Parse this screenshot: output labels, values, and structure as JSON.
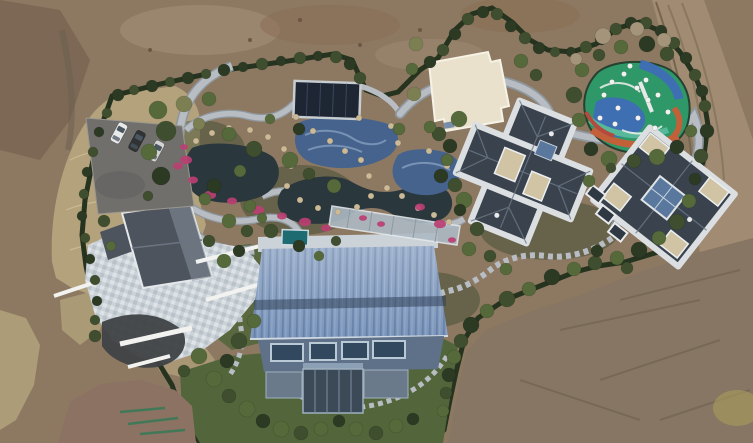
{
  "scene": {
    "type": "aerial-drone-photo",
    "description": "Top-down aerial drone photograph of a private landscaped estate under construction, surrounded by bare graded earth. The walled green compound contains an ornamental pond garden with winding stone paths and magenta flower beds, a dark solar canopy, a blue mosaic pool, a cream flat-roofed pavilion, a colorful children's playground, two dark slate-roofed villas with white roof rims, a gable-roofed house with a large stone patio, a big hall with a blue standing-seam metal roof, a glass walkway bridge, a small parking lot with three cars, and a curving asphalt driveway. A dirt track runs along the upper right edge.",
    "objects": [
      "bare earth surroundings",
      "boundary hedge",
      "dry grass bank",
      "asphalt driveway",
      "parking area with three cars",
      "ornamental pond garden",
      "winding stone paths",
      "magenta flower beds",
      "solar panel canopy",
      "blue mosaic pools",
      "cream flat-roof pavilion",
      "children's playground",
      "perimeter garden road",
      "slate-roof villa (center)",
      "slate-roof villa (east)",
      "gable-roof house with stone patio",
      "blue metal-roof hall",
      "glass walkway bridge",
      "stepped garden path",
      "white retaining walls",
      "lawn",
      "dirt access road",
      "green survey paint marks"
    ]
  },
  "colors": {
    "dirt_base": "#8d7962",
    "dirt_dark": "#6b5745",
    "dirt_red": "#8a6c52",
    "dirt_light": "#a5907a",
    "dirt_gray": "#877663",
    "dirt_patch": "#8b7263",
    "ridge": "#6a5d4e",
    "patch_yellow": "#a79a5c",
    "dry_grass": "#b3a27c",
    "dry_grass_light": "#cfc09a",
    "hedge": "#26331f",
    "garden": "#46543a",
    "garden_dark": "#39482e",
    "lawn": "#53663b",
    "bush_dark": "#2c3a24",
    "bush_mid": "#3e4e2e",
    "bush_green": "#55693a",
    "bush_olive": "#7c7f52",
    "bush_pale": "#95a46b",
    "tree_bare": "#a3947a",
    "road_asphalt": "#3f4245",
    "road_edge": "#d5d3cd",
    "dirt_road": "#a18c73",
    "rut": "#7f6e59",
    "path_stone": "#b7bdc2",
    "path_edge": "#8f979e",
    "patio_a": "#ccd3d8",
    "patio_b": "#dde3e7",
    "patio_c": "#b9c2c9",
    "pond": "#2a383d",
    "pool_blue": "#45638d",
    "pool_wave": "#7e98ba",
    "flower": "#bb3f72",
    "rock": "#ccba96",
    "wall_white": "#f2f3f1",
    "roof_slate": "#3a434d",
    "roof_rim": "#dcdfe2",
    "roof_tan": "#d0c4a5",
    "skylight": "#5a789e",
    "facet": "#6d7987",
    "roof_gable": "#4d545e",
    "gable_sheen": "#858e9b",
    "barn_roof": "#7b95ba",
    "barn_rib": "#5f7aa4",
    "barn_rib_light": "#93abc9",
    "barn_dark_band": "#2f4158",
    "barn_eave": "#cfd8e2",
    "facade": "#5e7188",
    "window": "#31485e",
    "window_frame": "#b9c9d6",
    "louver": "#6b7a8a",
    "glass_dark": "#3c4a57",
    "glass_mullion": "#7b8da0",
    "hottub": "#1f6b72",
    "bridge": "#aebac4",
    "pavilion": "#e9e1cc",
    "pavilion_edge": "#f6f2e5",
    "pg_green": "#2f9868",
    "pg_blue": "#3e6fb3",
    "pg_teal": "#58b89a",
    "pg_orange": "#c2603a",
    "pg_red": "#b34a3e",
    "pg_white": "#f0f2f0",
    "solar": "#1e2633",
    "solar_frame": "#c8cdd2",
    "car_white": "#e9eaea",
    "car_dark": "#303234",
    "car_silver": "#d3d4d2",
    "car_glass": "#4a5660",
    "paint_green": "#2f7a56"
  },
  "landscape": {
    "shrubs": [
      [
        118,
        95,
        6,
        0
      ],
      [
        134,
        90,
        5,
        1
      ],
      [
        152,
        86,
        6,
        0
      ],
      [
        170,
        82,
        5,
        1
      ],
      [
        188,
        78,
        6,
        0
      ],
      [
        206,
        74,
        5,
        1
      ],
      [
        224,
        70,
        6,
        0
      ],
      [
        243,
        67,
        5,
        0
      ],
      [
        262,
        64,
        6,
        1
      ],
      [
        281,
        61,
        5,
        0
      ],
      [
        300,
        58,
        6,
        1
      ],
      [
        318,
        56,
        5,
        0
      ],
      [
        336,
        57,
        6,
        1
      ],
      [
        350,
        64,
        6,
        0
      ],
      [
        360,
        78,
        6,
        1
      ],
      [
        430,
        62,
        6,
        0
      ],
      [
        443,
        50,
        6,
        1
      ],
      [
        455,
        34,
        6,
        0
      ],
      [
        468,
        19,
        6,
        1
      ],
      [
        483,
        12,
        6,
        0
      ],
      [
        497,
        14,
        6,
        1
      ],
      [
        511,
        26,
        6,
        0
      ],
      [
        525,
        38,
        6,
        1
      ],
      [
        539,
        48,
        6,
        0
      ],
      [
        555,
        52,
        5,
        1
      ],
      [
        571,
        52,
        5,
        0
      ],
      [
        586,
        47,
        6,
        1
      ],
      [
        601,
        39,
        6,
        0
      ],
      [
        616,
        29,
        6,
        1
      ],
      [
        631,
        23,
        6,
        0
      ],
      [
        646,
        23,
        6,
        1
      ],
      [
        661,
        31,
        6,
        0
      ],
      [
        674,
        43,
        6,
        1
      ],
      [
        686,
        58,
        6,
        0
      ],
      [
        695,
        75,
        6,
        1
      ],
      [
        702,
        91,
        6,
        0
      ],
      [
        107,
        113,
        5,
        1
      ],
      [
        99,
        132,
        5,
        0
      ],
      [
        93,
        152,
        5,
        1
      ],
      [
        87,
        172,
        5,
        0
      ],
      [
        84,
        194,
        5,
        1
      ],
      [
        82,
        216,
        5,
        0
      ],
      [
        85,
        238,
        5,
        1
      ],
      [
        90,
        259,
        5,
        0
      ],
      [
        95,
        280,
        5,
        1
      ],
      [
        97,
        301,
        5,
        0
      ],
      [
        95,
        320,
        5,
        1
      ],
      [
        158,
        110,
        9,
        2
      ],
      [
        184,
        104,
        8,
        3
      ],
      [
        209,
        99,
        7,
        2
      ],
      [
        166,
        131,
        10,
        1
      ],
      [
        149,
        152,
        8,
        2
      ],
      [
        161,
        176,
        9,
        0
      ],
      [
        199,
        124,
        6,
        3
      ],
      [
        229,
        134,
        7,
        2
      ],
      [
        254,
        149,
        8,
        1
      ],
      [
        240,
        171,
        6,
        2
      ],
      [
        214,
        186,
        7,
        0
      ],
      [
        290,
        160,
        8,
        2
      ],
      [
        309,
        174,
        6,
        1
      ],
      [
        334,
        186,
        7,
        2
      ],
      [
        299,
        129,
        6,
        0
      ],
      [
        270,
        119,
        5,
        2
      ],
      [
        414,
        94,
        7,
        3
      ],
      [
        399,
        129,
        6,
        2
      ],
      [
        439,
        134,
        7,
        1
      ],
      [
        459,
        119,
        8,
        2
      ],
      [
        441,
        176,
        7,
        0
      ],
      [
        464,
        200,
        8,
        2
      ],
      [
        477,
        229,
        7,
        1
      ],
      [
        412,
        69,
        6,
        2
      ],
      [
        416,
        44,
        7,
        3
      ],
      [
        521,
        61,
        7,
        2
      ],
      [
        536,
        75,
        6,
        1
      ],
      [
        430,
        127,
        6,
        2
      ],
      [
        450,
        146,
        7,
        0
      ],
      [
        582,
        70,
        7,
        2
      ],
      [
        574,
        95,
        8,
        1
      ],
      [
        579,
        120,
        7,
        2
      ],
      [
        591,
        149,
        7,
        0
      ],
      [
        609,
        159,
        8,
        2
      ],
      [
        634,
        161,
        7,
        1
      ],
      [
        657,
        157,
        8,
        2
      ],
      [
        677,
        147,
        7,
        0
      ],
      [
        691,
        131,
        6,
        2
      ],
      [
        599,
        55,
        6,
        1
      ],
      [
        621,
        47,
        7,
        2
      ],
      [
        647,
        44,
        8,
        0
      ],
      [
        667,
        54,
        7,
        1
      ],
      [
        603,
        36,
        8,
        5
      ],
      [
        637,
        29,
        7,
        5
      ],
      [
        664,
        40,
        7,
        5
      ],
      [
        576,
        59,
        6,
        5
      ],
      [
        705,
        106,
        6,
        1
      ],
      [
        707,
        131,
        7,
        0
      ],
      [
        701,
        156,
        7,
        1
      ],
      [
        695,
        179,
        6,
        0
      ],
      [
        689,
        201,
        7,
        2
      ],
      [
        677,
        222,
        8,
        1
      ],
      [
        659,
        238,
        7,
        2
      ],
      [
        639,
        250,
        8,
        0
      ],
      [
        617,
        258,
        7,
        2
      ],
      [
        595,
        263,
        7,
        1
      ],
      [
        574,
        269,
        7,
        2
      ],
      [
        552,
        277,
        8,
        0
      ],
      [
        529,
        289,
        7,
        2
      ],
      [
        507,
        299,
        8,
        1
      ],
      [
        487,
        311,
        7,
        2
      ],
      [
        471,
        325,
        8,
        0
      ],
      [
        461,
        341,
        7,
        1
      ],
      [
        454,
        357,
        7,
        2
      ],
      [
        449,
        375,
        7,
        0
      ],
      [
        446,
        393,
        6,
        1
      ],
      [
        443,
        411,
        6,
        2
      ],
      [
        447,
        160,
        6,
        2
      ],
      [
        455,
        185,
        7,
        1
      ],
      [
        460,
        210,
        6,
        0
      ],
      [
        469,
        249,
        7,
        2
      ],
      [
        490,
        256,
        6,
        1
      ],
      [
        506,
        269,
        6,
        2
      ],
      [
        611,
        168,
        5,
        1
      ],
      [
        589,
        181,
        6,
        2
      ],
      [
        597,
        251,
        6,
        0
      ],
      [
        627,
        268,
        6,
        1
      ],
      [
        229,
        221,
        7,
        2
      ],
      [
        247,
        231,
        6,
        1
      ],
      [
        262,
        218,
        5,
        2
      ],
      [
        239,
        251,
        6,
        0
      ],
      [
        224,
        261,
        7,
        2
      ],
      [
        209,
        241,
        6,
        1
      ],
      [
        254,
        321,
        7,
        2
      ],
      [
        239,
        341,
        8,
        1
      ],
      [
        227,
        361,
        7,
        0
      ],
      [
        214,
        379,
        8,
        2
      ],
      [
        229,
        396,
        7,
        1
      ],
      [
        247,
        409,
        8,
        2
      ],
      [
        263,
        421,
        7,
        0
      ],
      [
        281,
        429,
        8,
        2
      ],
      [
        301,
        433,
        7,
        1
      ],
      [
        321,
        429,
        7,
        2
      ],
      [
        339,
        421,
        6,
        0
      ],
      [
        356,
        429,
        7,
        2
      ],
      [
        376,
        433,
        7,
        1
      ],
      [
        396,
        426,
        7,
        2
      ],
      [
        413,
        419,
        6,
        0
      ],
      [
        104,
        221,
        6,
        1
      ],
      [
        111,
        246,
        5,
        2
      ],
      [
        95,
        336,
        6,
        1
      ],
      [
        205,
        199,
        6,
        2
      ],
      [
        148,
        196,
        5,
        1
      ],
      [
        199,
        356,
        8,
        2
      ],
      [
        184,
        371,
        6,
        1
      ],
      [
        250,
        206,
        6,
        2
      ],
      [
        271,
        231,
        7,
        1
      ],
      [
        299,
        246,
        6,
        0
      ],
      [
        319,
        256,
        5,
        2
      ],
      [
        336,
        241,
        5,
        1
      ]
    ],
    "rocks": [
      [
        196,
        141
      ],
      [
        212,
        133
      ],
      [
        229,
        128
      ],
      [
        250,
        130
      ],
      [
        268,
        137
      ],
      [
        284,
        149
      ],
      [
        291,
        166
      ],
      [
        287,
        186
      ],
      [
        300,
        200
      ],
      [
        318,
        208
      ],
      [
        338,
        212
      ],
      [
        357,
        207
      ],
      [
        371,
        196
      ],
      [
        387,
        188
      ],
      [
        402,
        196
      ],
      [
        418,
        208
      ],
      [
        434,
        215
      ],
      [
        449,
        222
      ],
      [
        361,
        160
      ],
      [
        345,
        151
      ],
      [
        330,
        141
      ],
      [
        313,
        131
      ],
      [
        369,
        176
      ],
      [
        429,
        151
      ],
      [
        447,
        166
      ],
      [
        455,
        186
      ],
      [
        296,
        117
      ],
      [
        359,
        118
      ],
      [
        391,
        126
      ],
      [
        398,
        143
      ]
    ],
    "flowers": [
      [
        186,
        160,
        6
      ],
      [
        193,
        180,
        5
      ],
      [
        210,
        195,
        6
      ],
      [
        232,
        201,
        5
      ],
      [
        258,
        210,
        6
      ],
      [
        282,
        216,
        5
      ],
      [
        305,
        222,
        6
      ],
      [
        326,
        228,
        5
      ],
      [
        420,
        207,
        5
      ],
      [
        440,
        224,
        6
      ],
      [
        452,
        240,
        4
      ],
      [
        381,
        224,
        4
      ],
      [
        363,
        218,
        4
      ],
      [
        184,
        147,
        4
      ],
      [
        178,
        166,
        5
      ]
    ],
    "equipment": [
      [
        612,
        82
      ],
      [
        624,
        74
      ],
      [
        637,
        88
      ],
      [
        648,
        100
      ],
      [
        618,
        108
      ],
      [
        638,
        118
      ],
      [
        658,
        95
      ],
      [
        630,
        66
      ],
      [
        604,
        95
      ],
      [
        655,
        128
      ],
      [
        668,
        112
      ],
      [
        600,
        118
      ],
      [
        646,
        80
      ],
      [
        615,
        124
      ]
    ],
    "cars": [
      {
        "x": 119,
        "y": 133,
        "angle": 28,
        "body": "car_white"
      },
      {
        "x": 137,
        "y": 141,
        "angle": 28,
        "body": "car_dark"
      },
      {
        "x": 156,
        "y": 151,
        "angle": 28,
        "body": "car_silver"
      }
    ]
  }
}
